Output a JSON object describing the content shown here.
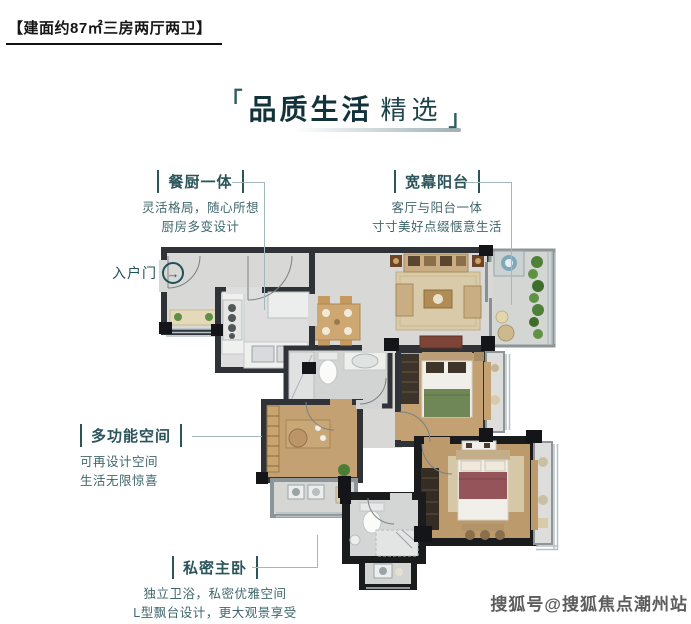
{
  "header": {
    "area_tag": "【建面约87㎡三房两厅两卫】"
  },
  "title": {
    "bracket_left": "「",
    "main": "品质生活",
    "accent": "精选",
    "bracket_right": "」"
  },
  "annotations": {
    "kitchen": {
      "label": "餐厨一体",
      "desc1": "灵活格局，随心所想",
      "desc2": "厨房多变设计"
    },
    "balcony": {
      "label": "宽幕阳台",
      "desc1": "客厅与阳台一体",
      "desc2": "寸寸美好点缀惬意生活"
    },
    "entry": {
      "label": "入户门",
      "arrow": "→"
    },
    "multi": {
      "label": "多功能空间",
      "desc1": "可再设计空间",
      "desc2": "生活无限惊喜"
    },
    "master": {
      "label": "私密主卧",
      "desc1": "独立卫浴，私密优雅空间",
      "desc2": "L型飘台设计，更大观景享受"
    }
  },
  "watermark": {
    "text": "搜狐号@搜狐焦点潮州站"
  },
  "colors": {
    "accent_teal": "#2b545b",
    "title_teal": "#12333a",
    "wall_dark": "#2f3236",
    "wall_black": "#1a1b1d",
    "marble_floor": "#d8d8d6",
    "wood_floor": "#c3a173",
    "bed_green": "#6f8657",
    "bed_maroon": "#95545a",
    "plant_green": "#4f8038"
  }
}
